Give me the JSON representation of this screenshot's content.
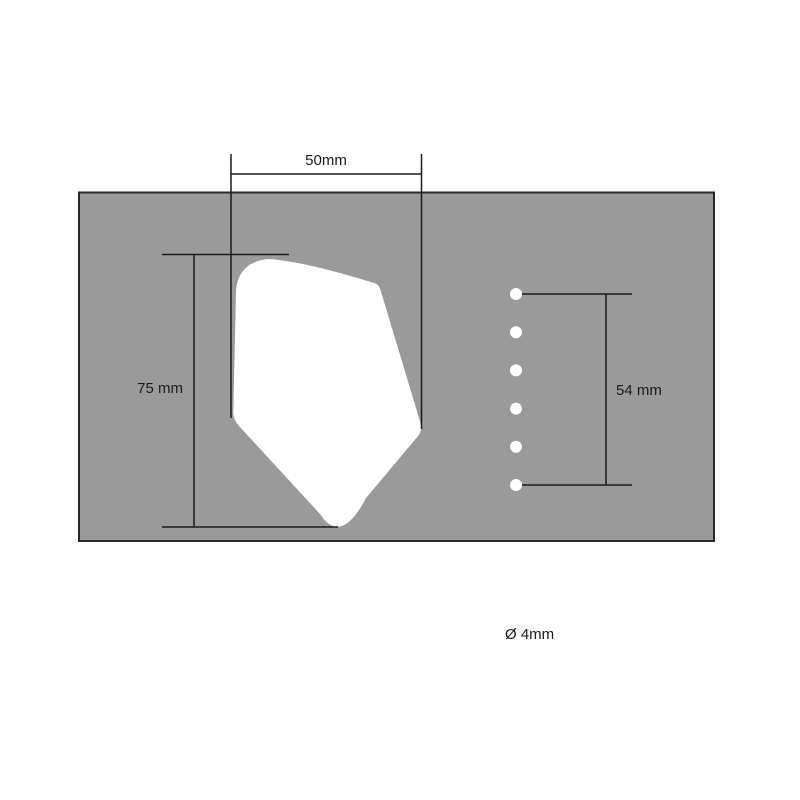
{
  "drawing": {
    "labels": {
      "width": "50mm",
      "height": "75 mm",
      "hole_span": "54 mm",
      "hole_diameter": "Ø 4mm"
    },
    "holes": {
      "count": 6
    },
    "colors": {
      "background": "#ffffff",
      "plate_fill": "#9a9a9a",
      "plate_border": "#2a2a2a",
      "cutout_fill": "#ffffff",
      "hole_fill": "#ffffff",
      "dimension_line": "#1a1a1a",
      "label_text": "#1a1a1a"
    }
  }
}
